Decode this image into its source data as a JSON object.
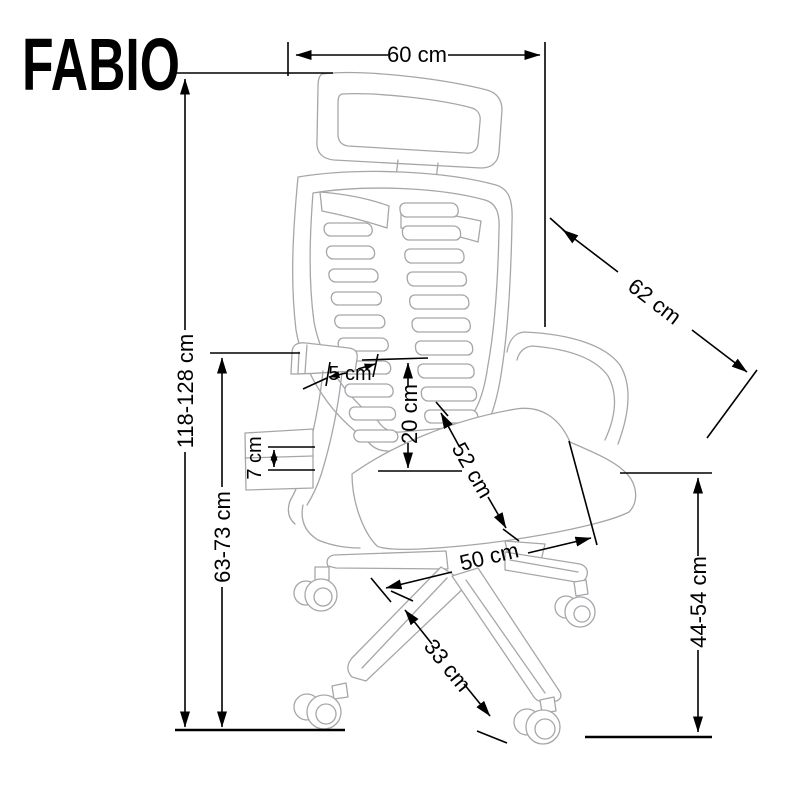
{
  "title": "FABIO",
  "diagram": {
    "type": "product-dimension-drawing",
    "subject": "office swivel chair, side view with headrest, mesh backrest, armrests and five-star caster base",
    "unit": "cm"
  },
  "colors": {
    "background": "#ffffff",
    "outline": "#a4a7aa",
    "dimension": "#000000"
  },
  "dims": {
    "d60": {
      "label": "60 cm",
      "orientation": "horizontal-top"
    },
    "d118": {
      "label": "118-128 cm",
      "orientation": "vertical-left-outer"
    },
    "d62": {
      "label": "62 cm",
      "orientation": "diagonal-backrest"
    },
    "d63": {
      "label": "63-73 cm",
      "orientation": "vertical-left-inner"
    },
    "d7": {
      "label": "7 cm",
      "orientation": "vertical-small-armrest"
    },
    "d5": {
      "label": "5 cm",
      "orientation": "horizontal-small-armrest"
    },
    "d20": {
      "label": "20 cm",
      "orientation": "vertical-lumbar"
    },
    "d52": {
      "label": "52 cm",
      "orientation": "diagonal-seat"
    },
    "d50": {
      "label": "50 cm",
      "orientation": "horizontal-base"
    },
    "d33": {
      "label": "33 cm",
      "orientation": "diagonal-base-leg"
    },
    "d44": {
      "label": "44-54 cm",
      "orientation": "vertical-right"
    }
  }
}
